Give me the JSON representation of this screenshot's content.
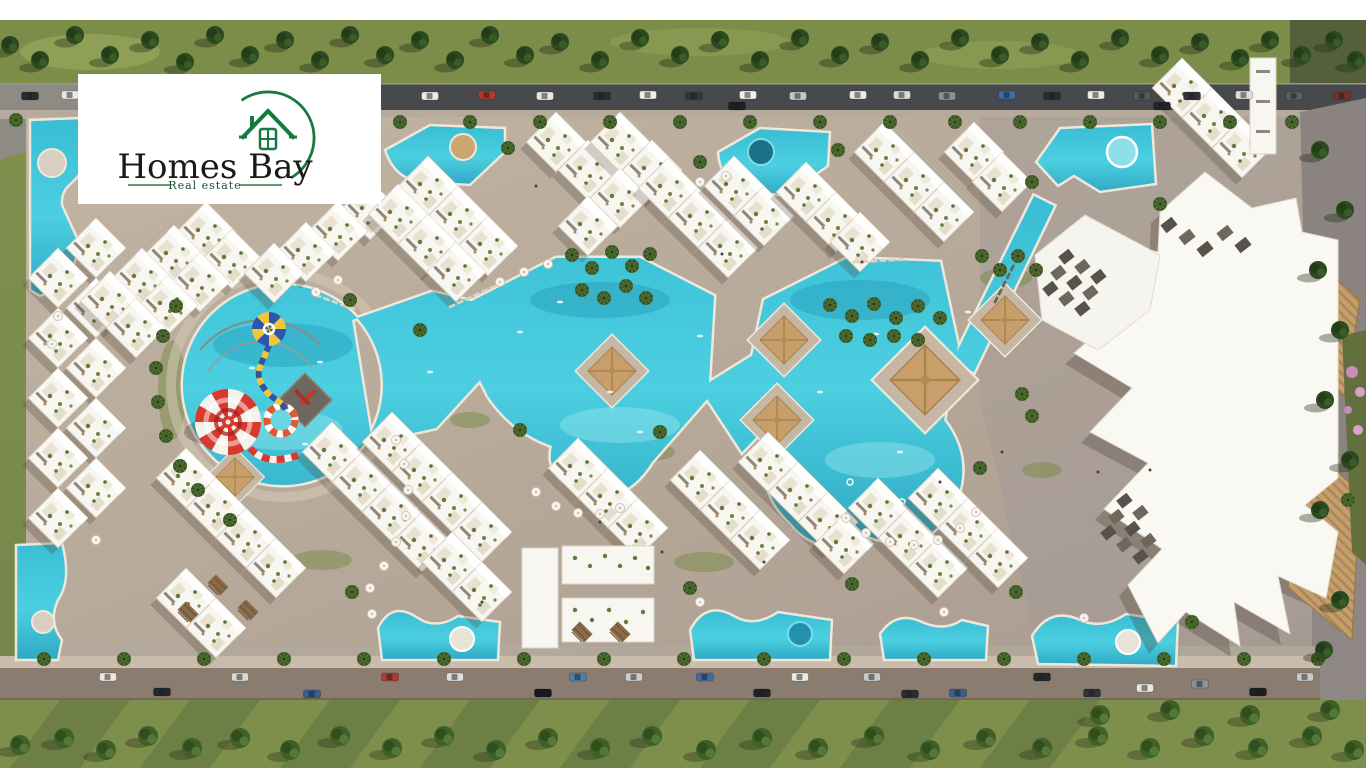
{
  "logo": {
    "brand": "Homes Bay",
    "tagline": "Real estate",
    "accent_green": "#157a3e",
    "text_color": "#1c1917"
  },
  "palette": {
    "pool_water": "#3fc6da",
    "pool_deep": "#2193b0",
    "pool_coping": "#efe8da",
    "site_paving": "#b9ab9b",
    "paving_shaded": "#9b938f",
    "road_asphalt": "#47494d",
    "road_bottom": "#8a7c6e",
    "grass": "#7e8e4b",
    "tree_dark": "#2c4a20",
    "building_white": "#f8f6f0",
    "roof_garden": "#64793c",
    "gazebo_tan": "#c89f6a",
    "boardwalk_wood": "#c59e6e",
    "slide_red": "#d8382e",
    "float_blue": "#2a57ab",
    "float_yellow": "#f0c63c"
  }
}
